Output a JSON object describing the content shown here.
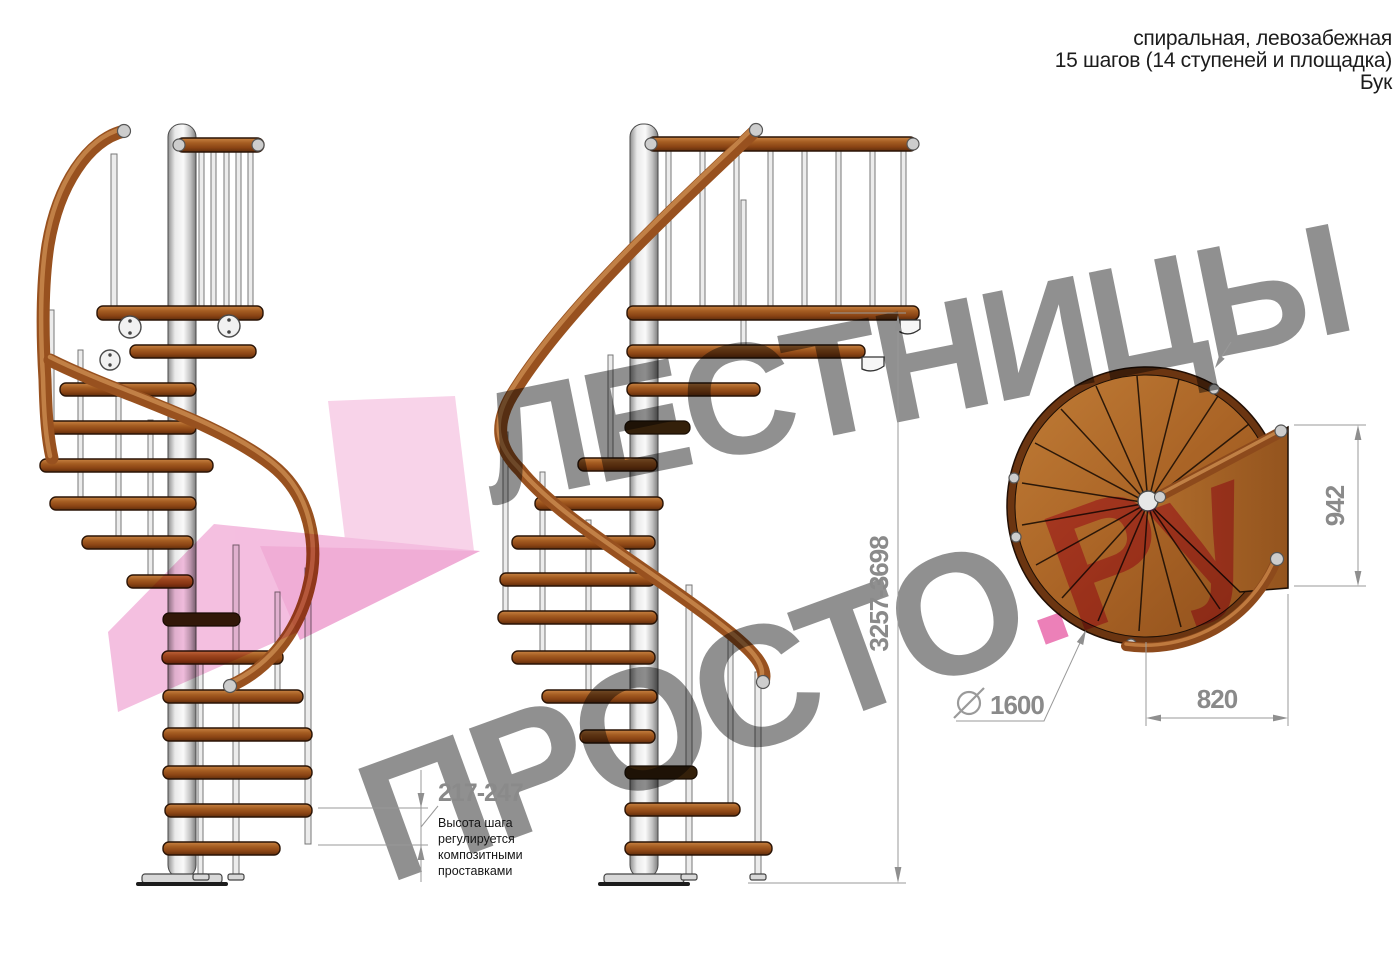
{
  "header": {
    "line1": "спиральная, левозабежная",
    "line2": "15 шагов (14 ступеней и площадка)",
    "line3": "Бук"
  },
  "watermark": {
    "line1": "ЛЕСТНИЦЫ",
    "line2": "ПРОСТО",
    "suffix": ".Ру",
    "gray": "#757575",
    "pink": "#e23a92"
  },
  "dimensions": {
    "total_height": "3257-3698",
    "step_height": "217-247",
    "landing_depth": "942",
    "landing_width": "820",
    "diameter": "1600"
  },
  "annotation": {
    "lines": [
      "Высота шага",
      "регулируется",
      "композитными",
      "проставками"
    ]
  },
  "colors": {
    "wood": "#a9601f",
    "rail": "#98511f",
    "pole": "#d9d9d9",
    "dim_gray": "#8f8f8f",
    "pink_light": "#f6c3e1",
    "pink_mid": "#f0a6d4"
  }
}
